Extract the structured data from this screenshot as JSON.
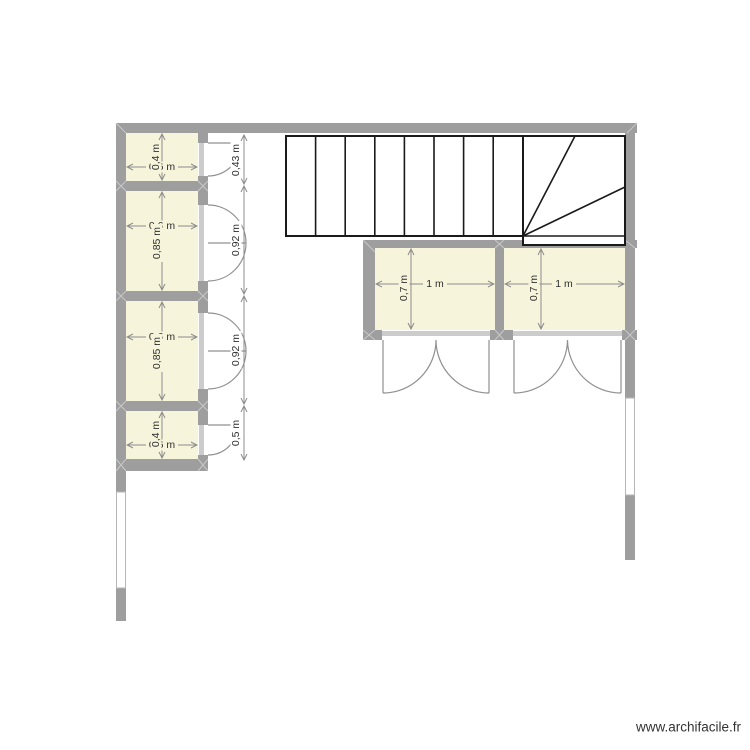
{
  "watermark": {
    "text": "www.archifacile.fr"
  },
  "rooms": [
    {
      "id": "room-1",
      "width": "0,6 m",
      "height": "0,4 m"
    },
    {
      "id": "room-2",
      "width": "0,6 m",
      "height": "0,85 m"
    },
    {
      "id": "room-3",
      "width": "0,6 m",
      "height": "0,85 m"
    },
    {
      "id": "room-4",
      "width": "0,6 m",
      "height": "0,4 m"
    },
    {
      "id": "room-5",
      "width": "1 m",
      "height": "0,7 m"
    },
    {
      "id": "room-6",
      "width": "1 m",
      "height": "0,7 m"
    }
  ],
  "corridor_openings": [
    {
      "label": "0,43 m"
    },
    {
      "label": "0,92 m"
    },
    {
      "label": "0,92 m"
    },
    {
      "label": "0,5 m"
    }
  ],
  "stairs": {
    "straight_treads": 8,
    "winder_treads": 3
  },
  "colors": {
    "wall": "#9E9E9E",
    "room_fill": "#F7F4DC",
    "door_sill": "#CCCCCC",
    "dimension": "#8C8C8C",
    "dimension_text": "#2F2F2F",
    "stair_line": "#1A1A1A",
    "door_arc": "#909090",
    "corner_mark": "#C8C8C8",
    "watermark_text": "#333333"
  }
}
